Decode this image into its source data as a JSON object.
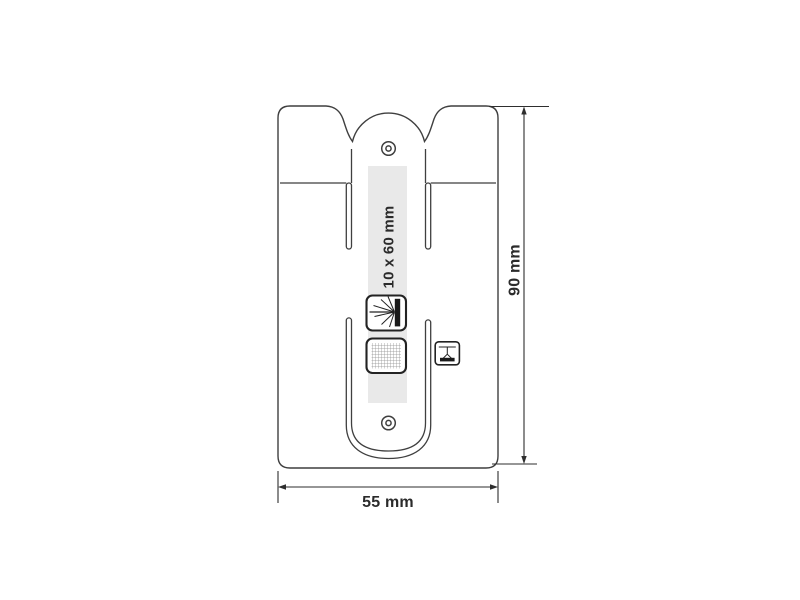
{
  "diagram": {
    "type": "technical-dimension-drawing",
    "product": "silicone card holder with stand",
    "dimensions": {
      "width_label": "55 mm",
      "height_label": "90 mm",
      "print_area_label": "10 x 60 mm"
    },
    "icons": {
      "laser_engraving": "laser-engraving-icon",
      "screen_print": "screen-print-mesh-icon",
      "pad_print": "pad-print-icon"
    },
    "colors": {
      "background": "#ffffff",
      "outline": "#3f3f3f",
      "dimension": "#2e2e2e",
      "text": "#2b2b2b",
      "print_area": "#e9e9e9",
      "icon_ink": "#1a1a1a"
    }
  }
}
